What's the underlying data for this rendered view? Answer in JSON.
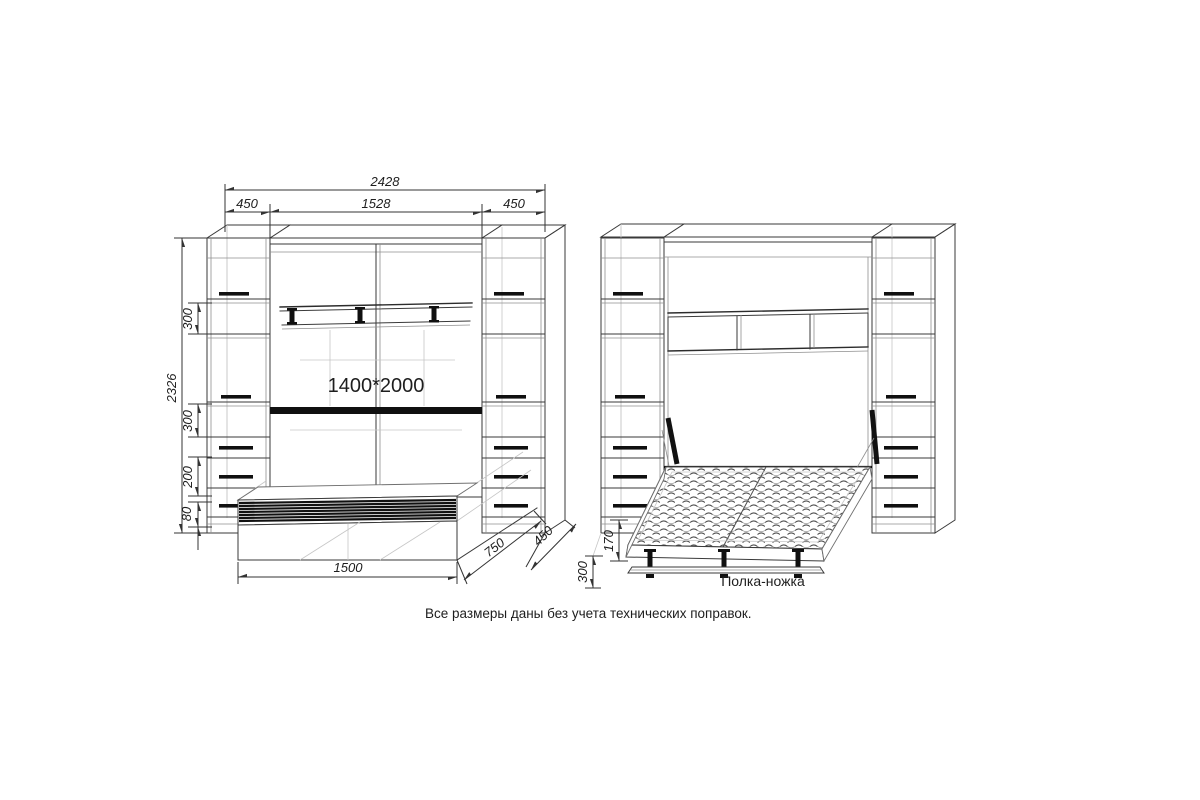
{
  "note": "Все размеры даны без учета технических поправок.",
  "closed_view": {
    "bed_size_label": "1400*2000",
    "dimensions": {
      "total_width": "2428",
      "left_cabinet_width": "450",
      "center_width": "1528",
      "right_cabinet_width": "450",
      "total_height": "2326",
      "upper_shelf_gap": "300",
      "lower_shelf_gap": "300",
      "drawer_section": "200",
      "plinth_height": "80",
      "bed_box_width": "1500",
      "bed_box_depth": "750",
      "cabinet_depth": "450"
    }
  },
  "open_view": {
    "leg_shelf_label": "Полка-ножка",
    "dimensions": {
      "bed_frame_height": "170",
      "leg_shelf_height": "300"
    }
  }
}
